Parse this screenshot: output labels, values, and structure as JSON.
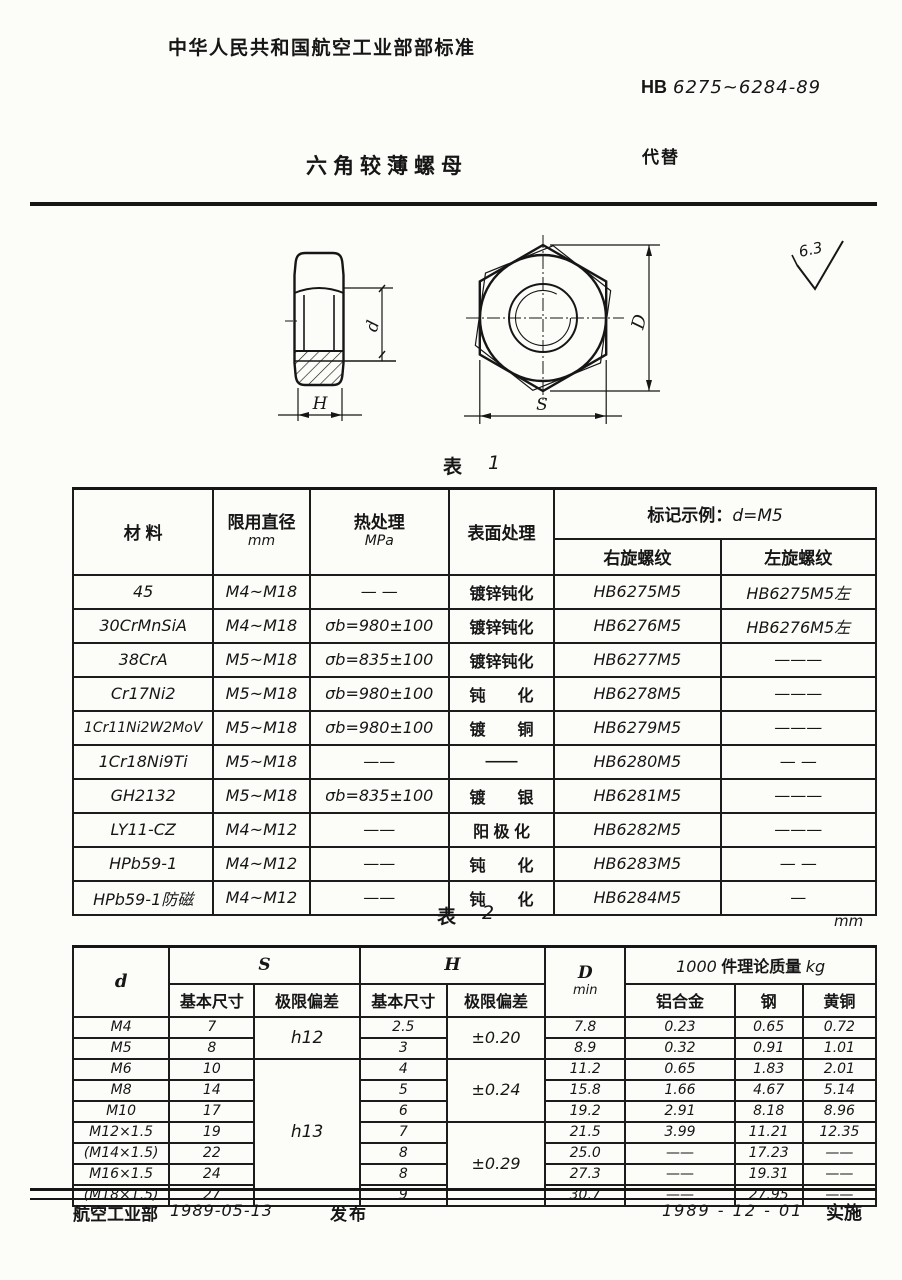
{
  "header": {
    "org_standard": "中华人民共和国航空工业部部标准",
    "standard_prefix": "HB",
    "standard_number": "6275~6284-89",
    "doc_title": "六角较薄螺母",
    "supersedes_label": "代替"
  },
  "drawing": {
    "dim_h": "H",
    "dim_d": "d",
    "dim_s": "S",
    "dim_D": "D",
    "roughness": "6.3"
  },
  "table1": {
    "caption_cn": "表",
    "caption_no": "1",
    "col_material": "材   料",
    "col_diameter": "限用直径",
    "col_diameter_unit": "mm",
    "col_heat": "热处理",
    "col_heat_unit": "MPa",
    "col_surface": "表面处理",
    "col_marking_cn": "标记示例：",
    "col_marking_val": "d=M5",
    "col_right_thread": "右旋螺纹",
    "col_left_thread": "左旋螺纹",
    "rows": [
      {
        "material": "45",
        "diameter": "M4~M18",
        "heat": "— —",
        "surface": "镀锌钝化",
        "right": "HB6275M5",
        "left": "HB6275M5左"
      },
      {
        "material": "30CrMnSiA",
        "diameter": "M4~M18",
        "heat": "σb=980±100",
        "surface": "镀锌钝化",
        "right": "HB6276M5",
        "left": "HB6276M5左"
      },
      {
        "material": "38CrA",
        "diameter": "M5~M18",
        "heat": "σb=835±100",
        "surface": "镀锌钝化",
        "right": "HB6277M5",
        "left": "———"
      },
      {
        "material": "Cr17Ni2",
        "diameter": "M5~M18",
        "heat": "σb=980±100",
        "surface": "钝　　化",
        "right": "HB6278M5",
        "left": "———"
      },
      {
        "material": "1Cr11Ni2W2MoV",
        "diameter": "M5~M18",
        "heat": "σb=980±100",
        "surface": "镀　　铜",
        "right": "HB6279M5",
        "left": "———"
      },
      {
        "material": "1Cr18Ni9Ti",
        "diameter": "M5~M18",
        "heat": "——",
        "surface": "——",
        "right": "HB6280M5",
        "left": "— —"
      },
      {
        "material": "GH2132",
        "diameter": "M5~M18",
        "heat": "σb=835±100",
        "surface": "镀　　银",
        "right": "HB6281M5",
        "left": "———"
      },
      {
        "material": "LY11-CZ",
        "diameter": "M4~M12",
        "heat": "——",
        "surface": "阳 极 化",
        "right": "HB6282M5",
        "left": "———"
      },
      {
        "material": "HPb59-1",
        "diameter": "M4~M12",
        "heat": "——",
        "surface": "钝　　化",
        "right": "HB6283M5",
        "left": "— —"
      },
      {
        "material": "HPb59-1防磁",
        "diameter": "M4~M12",
        "heat": "——",
        "surface": "钝　　化",
        "right": "HB6284M5",
        "left": "—"
      }
    ]
  },
  "table2": {
    "caption_cn": "表",
    "caption_no": "2",
    "unit": "mm",
    "col_d": "d",
    "col_s": "S",
    "col_h": "H",
    "col_D": "D",
    "col_D_sub": "min",
    "col_mass_num": "1000",
    "col_mass_cn": "件理论质量",
    "col_mass_unit": "kg",
    "sub_basic": "基本尺寸",
    "sub_dev": "极限偏差",
    "sub_al": "铝合金",
    "sub_steel": "钢",
    "sub_brass": "黄铜",
    "s_dev": [
      "h12",
      "h13"
    ],
    "h_dev": [
      "±0.20",
      "±0.24",
      "±0.29"
    ],
    "rows": [
      {
        "d": "M4",
        "s": "7",
        "h": "2.5",
        "dmin": "7.8",
        "al": "0.23",
        "steel": "0.65",
        "brass": "0.72"
      },
      {
        "d": "M5",
        "s": "8",
        "h": "3",
        "dmin": "8.9",
        "al": "0.32",
        "steel": "0.91",
        "brass": "1.01"
      },
      {
        "d": "M6",
        "s": "10",
        "h": "4",
        "dmin": "11.2",
        "al": "0.65",
        "steel": "1.83",
        "brass": "2.01"
      },
      {
        "d": "M8",
        "s": "14",
        "h": "5",
        "dmin": "15.8",
        "al": "1.66",
        "steel": "4.67",
        "brass": "5.14"
      },
      {
        "d": "M10",
        "s": "17",
        "h": "6",
        "dmin": "19.2",
        "al": "2.91",
        "steel": "8.18",
        "brass": "8.96"
      },
      {
        "d": "M12×1.5",
        "s": "19",
        "h": "7",
        "dmin": "21.5",
        "al": "3.99",
        "steel": "11.21",
        "brass": "12.35"
      },
      {
        "d": "(M14×1.5)",
        "s": "22",
        "h": "8",
        "dmin": "25.0",
        "al": "——",
        "steel": "17.23",
        "brass": "——"
      },
      {
        "d": "M16×1.5",
        "s": "24",
        "h": "8",
        "dmin": "27.3",
        "al": "——",
        "steel": "19.31",
        "brass": "——"
      },
      {
        "d": "(M18×1.5)",
        "s": "27",
        "h": "9",
        "dmin": "30.7",
        "al": "——",
        "steel": "27.95",
        "brass": "——"
      }
    ]
  },
  "footer": {
    "issuer": "航空工业部",
    "issue_date": "1989-05-13",
    "issue_label": "发布",
    "impl_date": "1989 - 12 - 01",
    "impl_label": "实施"
  }
}
